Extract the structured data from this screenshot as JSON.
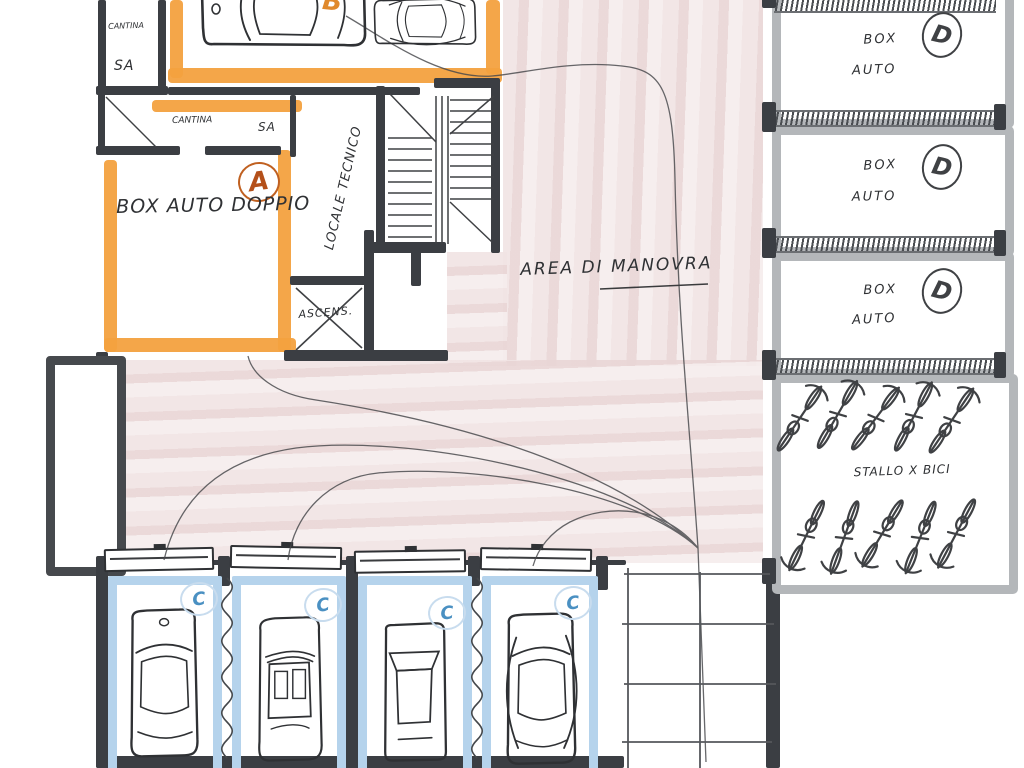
{
  "plan": {
    "labels": {
      "cantina_top": "CANTINA",
      "sa_top": "SA",
      "cantina_mid": "CANTINA",
      "sa_mid": "SA",
      "unit_a": "A",
      "unit_b": "B",
      "box_auto_doppio": "BOX AUTO DOPPIO",
      "locale_tecnico": "LOCALE TECNICO",
      "ascensore": "ASCENS.",
      "area_manovra": "AREA DI MANOVRA",
      "stallo_bici": "STALLO X BICI"
    },
    "right_boxes": [
      {
        "line1": "BOX",
        "line2": "AUTO",
        "letter": "D"
      },
      {
        "line1": "BOX",
        "line2": "AUTO",
        "letter": "D"
      },
      {
        "line1": "BOX",
        "line2": "AUTO",
        "letter": "D"
      }
    ],
    "stalls": [
      {
        "letter": "C"
      },
      {
        "letter": "C"
      },
      {
        "letter": "C"
      },
      {
        "letter": "C"
      }
    ],
    "colors": {
      "wall_dark": "#3b3e43",
      "highlight_orange": "#f3a13f",
      "highlight_blue": "#b5d3ec",
      "letter_blue": "#4a90c2",
      "wall_gray": "#b4b7ba",
      "floor_pink": "#efe2e2",
      "ink": "#2f3134",
      "accent_a": "#b4501a"
    }
  }
}
